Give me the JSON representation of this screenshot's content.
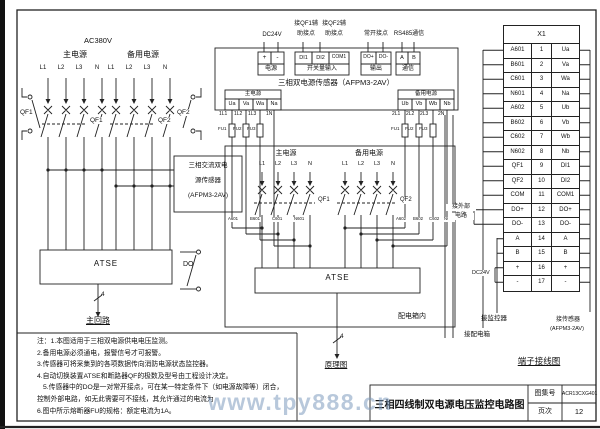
{
  "watermark": {
    "text": "www.tpy888.cn"
  },
  "left_diagram": {
    "voltage": "AC380V",
    "main_power": "主电源",
    "backup_power": "备用电源",
    "phases_main": [
      "L1",
      "L2",
      "L3",
      "N"
    ],
    "phases_backup": [
      "L1",
      "L2",
      "L3",
      "N"
    ],
    "breaker1": "QF1",
    "breaker2": "QF2",
    "aux1": "QF1",
    "aux2": "QF2",
    "sensor_line1": "三相交流双电",
    "sensor_line2": "源传感器",
    "sensor_line3": "(AFPM3-2AV)",
    "atse": "ATSE",
    "do_contact": "DO",
    "wire_count": "4",
    "caption": "主回路"
  },
  "middle_diagram": {
    "ann_dc24v": "DC24V",
    "ann_qf1_line1": "接QF1辅",
    "ann_qf1_line2": "助接点",
    "ann_qf2_line1": "接QF2辅",
    "ann_qf2_line2": "助接点",
    "ann_no": "常开接点",
    "ann_rs485": "RS485通信",
    "t_plus": "+",
    "t_minus": "-",
    "t_di1": "DI1",
    "t_di2": "DI2",
    "t_com1": "COM1",
    "t_dop": "DO+",
    "t_don": "DO-",
    "t_a": "A",
    "t_b": "B",
    "g_power": "电源",
    "g_di": "开关量输入",
    "g_out": "输出",
    "g_comm": "通信",
    "sensor_title": "三相双电源传感器（AFPM3-2AV）",
    "strip_main": "主电源",
    "strip_backup": "备用电源",
    "u_a": "Ua",
    "v_a": "Va",
    "w_a": "Wa",
    "n_a": "Na",
    "u_b": "Ub",
    "v_b": "Vb",
    "w_b": "Wb",
    "n_b": "Nb",
    "w_1l1": "1L1",
    "w_1l2": "1L2",
    "w_1l3": "1L3",
    "w_1n": "1N",
    "w_2l1": "2L1",
    "w_2l2": "2L2",
    "w_2l3": "2L3",
    "w_2n": "2N",
    "fu1": "FU1",
    "fu2": "FU2",
    "fu3": "FU3",
    "box_main": "主电源",
    "box_backup": "备用电源",
    "phases": [
      "L1",
      "L2",
      "L3",
      "N"
    ],
    "qf1": "QF1",
    "qf2": "QF2",
    "tap_a601": "A601",
    "tap_b601": "B601",
    "tap_c601": "C601",
    "tap_n601": "N601",
    "tap_a602": "A602",
    "tap_b602": "B602",
    "tap_c602": "C602",
    "tap_n602": "N602",
    "atse": "ATSE",
    "box_label": "配电箱内",
    "wire_count": "4",
    "caption": "原理图"
  },
  "terminal_section": {
    "table_title": "X1",
    "rows": [
      {
        "l": "A601",
        "n": "1",
        "r": "Ua"
      },
      {
        "l": "B601",
        "n": "2",
        "r": "Va"
      },
      {
        "l": "C601",
        "n": "3",
        "r": "Wa"
      },
      {
        "l": "N601",
        "n": "4",
        "r": "Na"
      },
      {
        "l": "A602",
        "n": "5",
        "r": "Ub"
      },
      {
        "l": "B602",
        "n": "6",
        "r": "Vb"
      },
      {
        "l": "C602",
        "n": "7",
        "r": "Wb"
      },
      {
        "l": "N602",
        "n": "8",
        "r": "Nb"
      },
      {
        "l": "QF1",
        "n": "9",
        "r": "DI1"
      },
      {
        "l": "QF2",
        "n": "10",
        "r": "DI2"
      },
      {
        "l": "COM",
        "n": "11",
        "r": "COM1"
      },
      {
        "l": "DO+",
        "n": "12",
        "r": "DO+"
      },
      {
        "l": "DO-",
        "n": "13",
        "r": "DO-"
      },
      {
        "l": "A",
        "n": "14",
        "r": "A"
      },
      {
        "l": "B",
        "n": "15",
        "r": "B"
      },
      {
        "l": "+",
        "n": "16",
        "r": "+"
      },
      {
        "l": "-",
        "n": "17",
        "r": "-"
      }
    ],
    "dc24v": "DC24V",
    "ext_line1": "接外部",
    "ext_line2": "电路",
    "monitor": "接监控器",
    "distbox": "接配电箱",
    "sensor_line1": "接传感器",
    "sensor_line2": "(AFPM3-2AV)",
    "caption": "端子接线图"
  },
  "notes": {
    "lines": [
      "注：1.本图适用于三相双电源供电电压监测。",
      "2.备用电源必须通电，报警信号才可报警。",
      "3.传感器可将采集到的各项数据传向消防电源状态监控器。",
      "4.自动切换装置ATSE和断路器QF的极数及型号由工程设计决定。",
      "5.传感器中的DO是一对常开接点，可在某一特定条件下（如电源故障等）闭合，",
      "控制外部电路，如无此需要可不接线，其允许通过的电流为",
      "6.图中所示熔断器FU的规格：额定电流为1A。"
    ]
  },
  "title_block": {
    "title": "三相四线制双电源电压监控电路图",
    "atlas_label": "图集号",
    "atlas_no": "ACR13CXG401",
    "page_label": "页次",
    "page_no": "12"
  }
}
